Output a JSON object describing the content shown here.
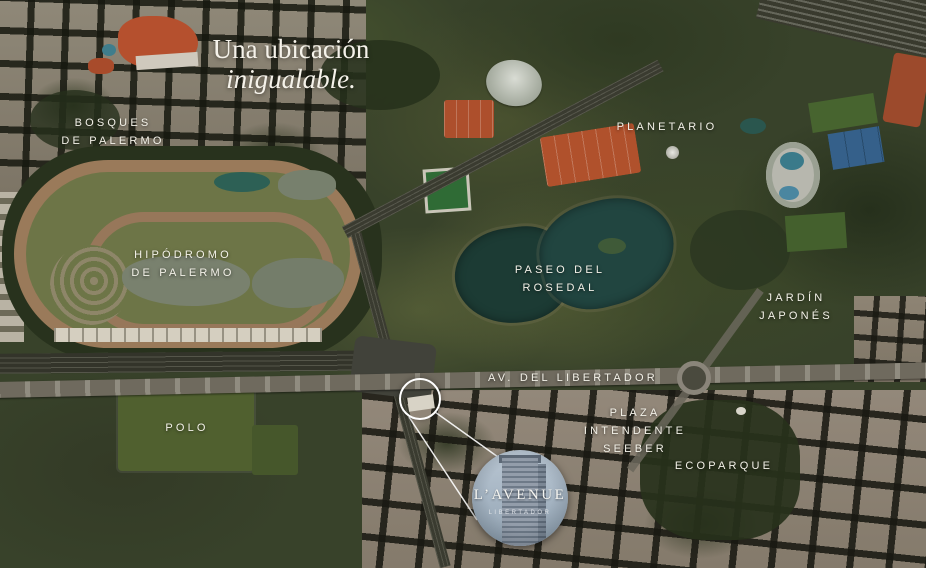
{
  "heading": {
    "line1": "Una ubicación",
    "line2": "inigualable."
  },
  "labels": [
    {
      "id": "bosques-de-palermo",
      "lines": [
        "BOSQUES",
        "DE PALERMO"
      ]
    },
    {
      "id": "hipodromo-de-palermo",
      "lines": [
        "HIPÓDROMO",
        "DE PALERMO"
      ]
    },
    {
      "id": "planetario",
      "lines": [
        "PLANETARIO"
      ]
    },
    {
      "id": "paseo-del-rosedal",
      "lines": [
        "PASEO DEL",
        "ROSEDAL"
      ]
    },
    {
      "id": "jardin-japones",
      "lines": [
        "JARDÍN",
        "JAPONÉS"
      ]
    },
    {
      "id": "av-del-libertador",
      "lines": [
        "AV. DEL LIBERTADOR"
      ]
    },
    {
      "id": "plaza-intendente-seeber",
      "lines": [
        "PLAZA",
        "INTENDENTE",
        "SEEBER"
      ]
    },
    {
      "id": "ecoparque",
      "lines": [
        "ECOPARQUE"
      ]
    },
    {
      "id": "polo",
      "lines": [
        "POLO"
      ]
    }
  ],
  "badge": {
    "title": "L’AVENUE",
    "subtitle": "LIBERTADOR"
  },
  "colors": {
    "label_text": "#f3f1e8",
    "lake_water": "#20433b",
    "race_track": "#9a7a5a",
    "polo_field": "#50602f",
    "avenue_road": "#6f6a5e",
    "clay_courts": "#b0512c",
    "marker_stroke": "#ffffff"
  }
}
